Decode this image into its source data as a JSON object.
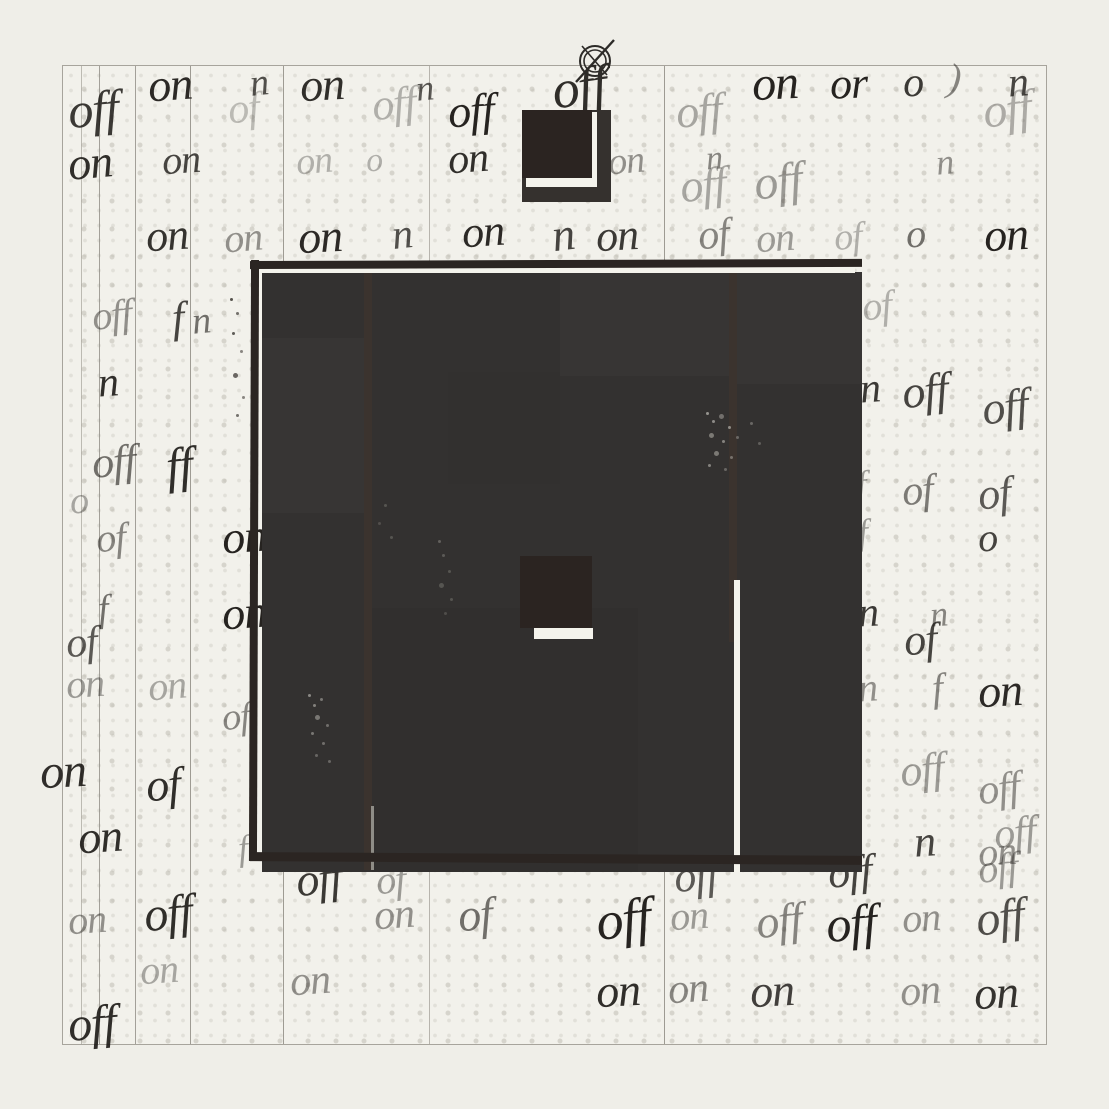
{
  "canvas": {
    "width": 1109,
    "height": 1109,
    "background": "#efeee8"
  },
  "palette": {
    "paper": "#f2f1eb",
    "halftone_dot": "#dcdad2",
    "ink": "#1c1916",
    "block_fill": "#333130",
    "block_border": "#2b2522",
    "dark_square": "#2b2421",
    "white_gap": "#f4f3ec",
    "ruled_line": "#8f8c84"
  },
  "paper": {
    "x": 62,
    "y": 65,
    "w": 985,
    "h": 980,
    "vlines": [
      {
        "x": 80,
        "o": 0.55
      },
      {
        "x": 98,
        "o": 0.8
      },
      {
        "x": 134,
        "o": 0.8
      },
      {
        "x": 189,
        "o": 0.85
      },
      {
        "x": 282,
        "o": 0.85
      },
      {
        "x": 428,
        "o": 0.6
      },
      {
        "x": 663,
        "o": 0.85
      }
    ]
  },
  "registration_mark": {
    "cx": 595,
    "cy": 61,
    "r_outer": 15,
    "r_inner": 11
  },
  "rects": [
    {
      "n": "back-square",
      "x": 522,
      "y": 110,
      "w": 89,
      "h": 92,
      "c": "#35312e"
    },
    {
      "n": "square-gap-h",
      "x": 526,
      "y": 178,
      "w": 71,
      "h": 9,
      "c": "#f4f3ec"
    },
    {
      "n": "square-gap-v",
      "x": 591,
      "y": 112,
      "w": 6,
      "h": 75,
      "c": "#f4f3ec"
    },
    {
      "n": "front-square",
      "x": 522,
      "y": 110,
      "w": 70,
      "h": 68,
      "c": "#2b2421"
    },
    {
      "n": "block-fill",
      "x": 262,
      "y": 272,
      "w": 600,
      "h": 600,
      "c": "#333130"
    },
    {
      "n": "tonal-patch",
      "x": 560,
      "y": 272,
      "w": 175,
      "h": 104,
      "c": "rgba(255,255,255,0.022)"
    },
    {
      "n": "tonal-patch",
      "x": 262,
      "y": 338,
      "w": 106,
      "h": 175,
      "c": "rgba(255,255,255,0.018)"
    },
    {
      "n": "tonal-patch",
      "x": 737,
      "y": 272,
      "w": 125,
      "h": 112,
      "c": "rgba(255,255,255,0.02)"
    },
    {
      "n": "tonal-patch",
      "x": 372,
      "y": 608,
      "w": 266,
      "h": 264,
      "c": "rgba(0,0,0,0.035)"
    },
    {
      "n": "tonal-patch",
      "x": 448,
      "y": 372,
      "w": 112,
      "h": 112,
      "c": "rgba(0,0,0,0.02)"
    },
    {
      "n": "divider-stripe",
      "x": 364,
      "y": 264,
      "w": 8,
      "h": 606,
      "c": "#3b332e"
    },
    {
      "n": "divider-sliver",
      "x": 371,
      "y": 806,
      "w": 3,
      "h": 64,
      "c": "#8f8d87"
    },
    {
      "n": "divider-stripe",
      "x": 729,
      "y": 264,
      "w": 8,
      "h": 378,
      "c": "#3b332e"
    },
    {
      "n": "white-stripe",
      "x": 734,
      "y": 580,
      "w": 6,
      "h": 292,
      "c": "#f4f3ec"
    },
    {
      "n": "inner-square",
      "x": 520,
      "y": 556,
      "w": 72,
      "h": 72,
      "c": "#2b2421"
    },
    {
      "n": "inner-square-underline",
      "x": 534,
      "y": 628,
      "w": 59,
      "h": 11,
      "c": "#f4f3ec"
    },
    {
      "n": "top-gap-highlight",
      "x": 258,
      "y": 267,
      "w": 597,
      "h": 6,
      "c": "#f4f3ec"
    },
    {
      "n": "left-gap-highlight",
      "x": 258,
      "y": 273,
      "w": 4,
      "h": 247,
      "c": "#f4f3ec"
    },
    {
      "n": "border-top",
      "x": 250,
      "y": 260,
      "w": 612,
      "h": 8,
      "c": "#2b2522",
      "r": -0.2
    },
    {
      "n": "border-left",
      "x": 250,
      "y": 260,
      "w": 8,
      "h": 601,
      "c": "#2b2522",
      "r": 0.2
    },
    {
      "n": "border-bottom",
      "x": 250,
      "y": 854,
      "w": 612,
      "h": 9,
      "c": "#2b2522",
      "r": 0.35
    }
  ],
  "words": [
    {
      "t": "off",
      "x": 68,
      "y": 84,
      "s": 50,
      "r": -5,
      "o": 0.85
    },
    {
      "t": "on",
      "x": 148,
      "y": 62,
      "s": 46,
      "r": -4,
      "o": 0.92
    },
    {
      "t": "of",
      "x": 228,
      "y": 88,
      "s": 42,
      "r": -6,
      "o": 0.25
    },
    {
      "t": "n",
      "x": 250,
      "y": 64,
      "s": 38,
      "r": -6,
      "o": 0.75
    },
    {
      "t": "on",
      "x": 300,
      "y": 62,
      "s": 46,
      "r": -3,
      "o": 0.9
    },
    {
      "t": "off",
      "x": 372,
      "y": 82,
      "s": 44,
      "r": -6,
      "o": 0.3
    },
    {
      "t": "n",
      "x": 416,
      "y": 70,
      "s": 36,
      "r": -5,
      "o": 0.7
    },
    {
      "t": "off",
      "x": 448,
      "y": 88,
      "s": 46,
      "r": -4,
      "o": 0.95
    },
    {
      "t": "off",
      "x": 552,
      "y": 60,
      "s": 54,
      "r": -8,
      "o": 0.9
    },
    {
      "t": "off",
      "x": 676,
      "y": 88,
      "s": 46,
      "r": -5,
      "o": 0.35
    },
    {
      "t": "on",
      "x": 752,
      "y": 60,
      "s": 48,
      "r": -3,
      "o": 0.95
    },
    {
      "t": "or",
      "x": 830,
      "y": 62,
      "s": 44,
      "r": -2,
      "o": 0.95
    },
    {
      "t": "o",
      "x": 903,
      "y": 62,
      "s": 42,
      "r": -2,
      "o": 0.85
    },
    {
      "t": ")",
      "x": 948,
      "y": 58,
      "s": 40,
      "r": 6,
      "o": 0.5
    },
    {
      "t": "n",
      "x": 1008,
      "y": 62,
      "s": 42,
      "r": -4,
      "o": 0.8
    },
    {
      "t": "off",
      "x": 983,
      "y": 86,
      "s": 48,
      "r": -7,
      "o": 0.32
    },
    {
      "t": "on",
      "x": 68,
      "y": 140,
      "s": 46,
      "r": -5,
      "o": 0.9
    },
    {
      "t": "on",
      "x": 162,
      "y": 140,
      "s": 40,
      "r": -4,
      "o": 0.8
    },
    {
      "t": "on",
      "x": 296,
      "y": 142,
      "s": 38,
      "r": -5,
      "o": 0.3
    },
    {
      "t": "o",
      "x": 366,
      "y": 144,
      "s": 34,
      "r": -4,
      "o": 0.3
    },
    {
      "t": "on",
      "x": 448,
      "y": 138,
      "s": 42,
      "r": -4,
      "o": 0.9
    },
    {
      "t": "on",
      "x": 608,
      "y": 142,
      "s": 38,
      "r": -5,
      "o": 0.45
    },
    {
      "t": "n",
      "x": 706,
      "y": 142,
      "s": 34,
      "r": -4,
      "o": 0.5
    },
    {
      "t": "off",
      "x": 680,
      "y": 162,
      "s": 46,
      "r": -6,
      "o": 0.35
    },
    {
      "t": "off",
      "x": 754,
      "y": 158,
      "s": 48,
      "r": -7,
      "o": 0.4
    },
    {
      "t": "n",
      "x": 936,
      "y": 144,
      "s": 36,
      "r": -5,
      "o": 0.45
    },
    {
      "t": "on",
      "x": 146,
      "y": 214,
      "s": 44,
      "r": -4,
      "o": 0.88
    },
    {
      "t": "on",
      "x": 224,
      "y": 218,
      "s": 40,
      "r": -5,
      "o": 0.45
    },
    {
      "t": "on",
      "x": 298,
      "y": 214,
      "s": 46,
      "r": -3,
      "o": 0.92
    },
    {
      "t": "n",
      "x": 392,
      "y": 214,
      "s": 42,
      "r": -6,
      "o": 0.75
    },
    {
      "t": "on",
      "x": 462,
      "y": 210,
      "s": 44,
      "r": -4,
      "o": 0.92
    },
    {
      "t": "n",
      "x": 552,
      "y": 212,
      "s": 46,
      "r": -7,
      "o": 0.8
    },
    {
      "t": "on",
      "x": 596,
      "y": 214,
      "s": 44,
      "r": -3,
      "o": 0.85
    },
    {
      "t": "of",
      "x": 698,
      "y": 214,
      "s": 42,
      "r": -6,
      "o": 0.5
    },
    {
      "t": "on",
      "x": 756,
      "y": 218,
      "s": 40,
      "r": -4,
      "o": 0.4
    },
    {
      "t": "of",
      "x": 834,
      "y": 218,
      "s": 38,
      "r": -5,
      "o": 0.3
    },
    {
      "t": "o",
      "x": 906,
      "y": 214,
      "s": 40,
      "r": -2,
      "o": 0.6
    },
    {
      "t": "on",
      "x": 984,
      "y": 212,
      "s": 46,
      "r": -3,
      "o": 0.95
    },
    {
      "t": "off",
      "x": 92,
      "y": 295,
      "s": 40,
      "r": -6,
      "o": 0.45
    },
    {
      "t": "f",
      "x": 172,
      "y": 296,
      "s": 44,
      "r": -4,
      "o": 0.8
    },
    {
      "t": "n",
      "x": 192,
      "y": 302,
      "s": 38,
      "r": -5,
      "o": 0.6
    },
    {
      "t": "n",
      "x": 98,
      "y": 362,
      "s": 42,
      "r": -4,
      "o": 0.9
    },
    {
      "t": "off",
      "x": 92,
      "y": 440,
      "s": 44,
      "r": -5,
      "o": 0.6
    },
    {
      "t": "ff",
      "x": 166,
      "y": 440,
      "s": 50,
      "r": -6,
      "o": 0.9
    },
    {
      "t": "o",
      "x": 70,
      "y": 482,
      "s": 38,
      "r": -3,
      "o": 0.35
    },
    {
      "t": "of",
      "x": 96,
      "y": 518,
      "s": 40,
      "r": -5,
      "o": 0.5
    },
    {
      "t": "on",
      "x": 222,
      "y": 514,
      "s": 46,
      "r": -4,
      "o": 0.95
    },
    {
      "t": "f",
      "x": 98,
      "y": 590,
      "s": 38,
      "r": -4,
      "o": 0.6
    },
    {
      "t": "on",
      "x": 222,
      "y": 590,
      "s": 46,
      "r": -4,
      "o": 0.95
    },
    {
      "t": "of",
      "x": 66,
      "y": 622,
      "s": 42,
      "r": -5,
      "o": 0.7
    },
    {
      "t": "on",
      "x": 66,
      "y": 664,
      "s": 40,
      "r": -4,
      "o": 0.4
    },
    {
      "t": "on",
      "x": 148,
      "y": 666,
      "s": 40,
      "r": -5,
      "o": 0.35
    },
    {
      "t": "of",
      "x": 222,
      "y": 698,
      "s": 38,
      "r": -5,
      "o": 0.5
    },
    {
      "t": "on",
      "x": 40,
      "y": 748,
      "s": 48,
      "r": -3,
      "o": 0.9
    },
    {
      "t": "of",
      "x": 146,
      "y": 762,
      "s": 46,
      "r": -5,
      "o": 0.9
    },
    {
      "t": "on",
      "x": 78,
      "y": 814,
      "s": 46,
      "r": -4,
      "o": 0.9
    },
    {
      "t": "f",
      "x": 238,
      "y": 830,
      "s": 36,
      "r": -5,
      "o": 0.4
    },
    {
      "t": "of",
      "x": 862,
      "y": 286,
      "s": 40,
      "r": -6,
      "o": 0.3
    },
    {
      "t": "n",
      "x": 860,
      "y": 368,
      "s": 42,
      "r": -4,
      "o": 0.85
    },
    {
      "t": "off",
      "x": 902,
      "y": 368,
      "s": 46,
      "r": -6,
      "o": 0.8
    },
    {
      "t": "off",
      "x": 982,
      "y": 384,
      "s": 46,
      "r": -7,
      "o": 0.75
    },
    {
      "t": "f",
      "x": 856,
      "y": 466,
      "s": 38,
      "r": -4,
      "o": 0.4
    },
    {
      "t": "of",
      "x": 902,
      "y": 470,
      "s": 42,
      "r": -5,
      "o": 0.55
    },
    {
      "t": "of",
      "x": 978,
      "y": 472,
      "s": 44,
      "r": -6,
      "o": 0.7
    },
    {
      "t": "o",
      "x": 978,
      "y": 518,
      "s": 40,
      "r": -3,
      "o": 0.8
    },
    {
      "t": "f",
      "x": 858,
      "y": 514,
      "s": 36,
      "r": -4,
      "o": 0.4
    },
    {
      "t": "n",
      "x": 858,
      "y": 592,
      "s": 42,
      "r": -3,
      "o": 0.85
    },
    {
      "t": "n",
      "x": 930,
      "y": 596,
      "s": 36,
      "r": -5,
      "o": 0.5
    },
    {
      "t": "of",
      "x": 904,
      "y": 618,
      "s": 44,
      "r": -5,
      "o": 0.8
    },
    {
      "t": "n",
      "x": 858,
      "y": 668,
      "s": 40,
      "r": -4,
      "o": 0.45
    },
    {
      "t": "f",
      "x": 932,
      "y": 668,
      "s": 40,
      "r": -5,
      "o": 0.5
    },
    {
      "t": "on",
      "x": 978,
      "y": 668,
      "s": 46,
      "r": -3,
      "o": 0.92
    },
    {
      "t": "off",
      "x": 900,
      "y": 748,
      "s": 44,
      "r": -6,
      "o": 0.4
    },
    {
      "t": "off",
      "x": 978,
      "y": 768,
      "s": 42,
      "r": -7,
      "o": 0.45
    },
    {
      "t": "n",
      "x": 914,
      "y": 820,
      "s": 44,
      "r": -4,
      "o": 0.8
    },
    {
      "t": "off",
      "x": 994,
      "y": 812,
      "s": 42,
      "r": -6,
      "o": 0.4
    },
    {
      "t": "on",
      "x": 978,
      "y": 832,
      "s": 40,
      "r": -4,
      "o": 0.45
    },
    {
      "t": "off",
      "x": 296,
      "y": 856,
      "s": 46,
      "r": -6,
      "o": 0.85
    },
    {
      "t": "of",
      "x": 376,
      "y": 860,
      "s": 40,
      "r": -5,
      "o": 0.4
    },
    {
      "t": "on",
      "x": 374,
      "y": 894,
      "s": 42,
      "r": -4,
      "o": 0.45
    },
    {
      "t": "of",
      "x": 458,
      "y": 892,
      "s": 46,
      "r": -5,
      "o": 0.6
    },
    {
      "t": "off",
      "x": 674,
      "y": 854,
      "s": 44,
      "r": -6,
      "o": 0.7
    },
    {
      "t": "off",
      "x": 828,
      "y": 850,
      "s": 44,
      "r": -5,
      "o": 0.8
    },
    {
      "t": "off",
      "x": 978,
      "y": 848,
      "s": 40,
      "r": -6,
      "o": 0.4
    },
    {
      "t": "off",
      "x": 144,
      "y": 890,
      "s": 48,
      "r": -6,
      "o": 0.9
    },
    {
      "t": "on",
      "x": 68,
      "y": 900,
      "s": 40,
      "r": -4,
      "o": 0.45
    },
    {
      "t": "off",
      "x": 596,
      "y": 892,
      "s": 54,
      "r": -7,
      "o": 0.95
    },
    {
      "t": "on",
      "x": 670,
      "y": 896,
      "s": 40,
      "r": -4,
      "o": 0.4
    },
    {
      "t": "off",
      "x": 756,
      "y": 898,
      "s": 46,
      "r": -6,
      "o": 0.5
    },
    {
      "t": "off",
      "x": 826,
      "y": 898,
      "s": 50,
      "r": -5,
      "o": 0.95
    },
    {
      "t": "on",
      "x": 902,
      "y": 898,
      "s": 40,
      "r": -4,
      "o": 0.45
    },
    {
      "t": "off",
      "x": 976,
      "y": 894,
      "s": 48,
      "r": -7,
      "o": 0.75
    },
    {
      "t": "on",
      "x": 140,
      "y": 950,
      "s": 40,
      "r": -4,
      "o": 0.35
    },
    {
      "t": "on",
      "x": 290,
      "y": 960,
      "s": 42,
      "r": -4,
      "o": 0.45
    },
    {
      "t": "on",
      "x": 596,
      "y": 968,
      "s": 46,
      "r": -3,
      "o": 0.9
    },
    {
      "t": "on",
      "x": 668,
      "y": 968,
      "s": 42,
      "r": -4,
      "o": 0.5
    },
    {
      "t": "on",
      "x": 750,
      "y": 968,
      "s": 46,
      "r": -3,
      "o": 0.82
    },
    {
      "t": "on",
      "x": 900,
      "y": 970,
      "s": 42,
      "r": -4,
      "o": 0.45
    },
    {
      "t": "on",
      "x": 974,
      "y": 970,
      "s": 46,
      "r": -3,
      "o": 0.88
    },
    {
      "t": "off",
      "x": 68,
      "y": 1000,
      "s": 48,
      "r": -5,
      "o": 0.9
    }
  ]
}
